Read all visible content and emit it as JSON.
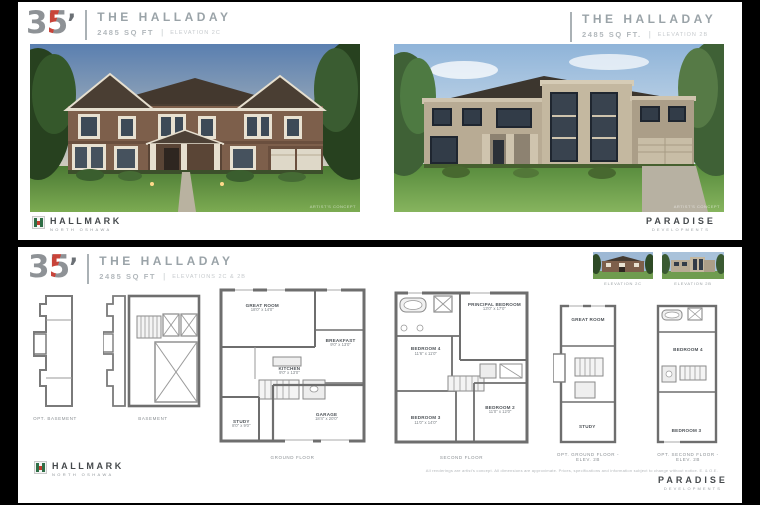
{
  "brand": {
    "logo": {
      "number": "35",
      "apostrophe": "’"
    },
    "hallmark": {
      "name": "HALLMARK",
      "tagline": "NORTH OSHAWA"
    },
    "paradise": {
      "name": "PARADISE",
      "tagline": "DEVELOPMENTS"
    }
  },
  "top": {
    "left": {
      "model": "THE HALLADAY",
      "sqft": "2485 SQ FT",
      "pipe": "|",
      "elevation": "ELEVATION 2C",
      "watermark": "ARTIST'S CONCEPT"
    },
    "right": {
      "model": "THE HALLADAY",
      "sqft": "2485 SQ FT.",
      "pipe": "|",
      "elevation": "ELEVATION 2B",
      "watermark": "ARTIST'S CONCEPT"
    }
  },
  "bottom": {
    "header": {
      "model": "THE HALLADAY",
      "sqft": "2485 SQ FT",
      "pipe": "|",
      "elevation": "ELEVATIONS 2C & 2B"
    },
    "thumbnails": [
      {
        "caption": "ELEVATION 2C"
      },
      {
        "caption": "ELEVATION 2B"
      }
    ],
    "plans": {
      "strip": {
        "caption": "OPT. BASEMENT"
      },
      "basement": {
        "caption": "BASEMENT"
      },
      "ground": {
        "caption": "GROUND FLOOR",
        "rooms": {
          "great": {
            "name": "GREAT ROOM",
            "dims": "18'0\" x 14'0\""
          },
          "breakfast": {
            "name": "BREAKFAST",
            "dims": "9'0\" x 13'0\""
          },
          "kitchen": {
            "name": "KITCHEN",
            "dims": "9'0\" x 13'0\""
          },
          "study": {
            "name": "STUDY",
            "dims": "8'0\" x 9'0\""
          },
          "garage": {
            "name": "GARAGE",
            "dims": "18'4\" x 20'0\""
          }
        }
      },
      "second": {
        "caption": "SECOND FLOOR",
        "rooms": {
          "principal": {
            "name": "PRINCIPAL BEDROOM",
            "dims": "13'0\" x 17'0\""
          },
          "bed4": {
            "name": "BEDROOM 4",
            "dims": "11'6\" x 11'0\""
          },
          "bed3": {
            "name": "BEDROOM 3",
            "dims": "11'0\" x 14'0\""
          },
          "bed2": {
            "name": "BEDROOM 2",
            "dims": "11'0\" x 12'0\""
          }
        }
      },
      "opt_ground": {
        "caption": "OPT. GROUND FLOOR - ELEV. 2B",
        "rooms": {
          "great": {
            "name": "GREAT ROOM"
          },
          "study": {
            "name": "STUDY"
          }
        }
      },
      "opt_second": {
        "caption": "OPT. SECOND FLOOR - ELEV. 2B",
        "rooms": {
          "bed4": {
            "name": "BEDROOM 4"
          },
          "bed3": {
            "name": "BEDROOM 3"
          }
        }
      }
    },
    "disclaimer": "All renderings are artist's concept. All dimensions are approximate. Prices, specifications and information subject to change without notice. E. & O.E."
  }
}
